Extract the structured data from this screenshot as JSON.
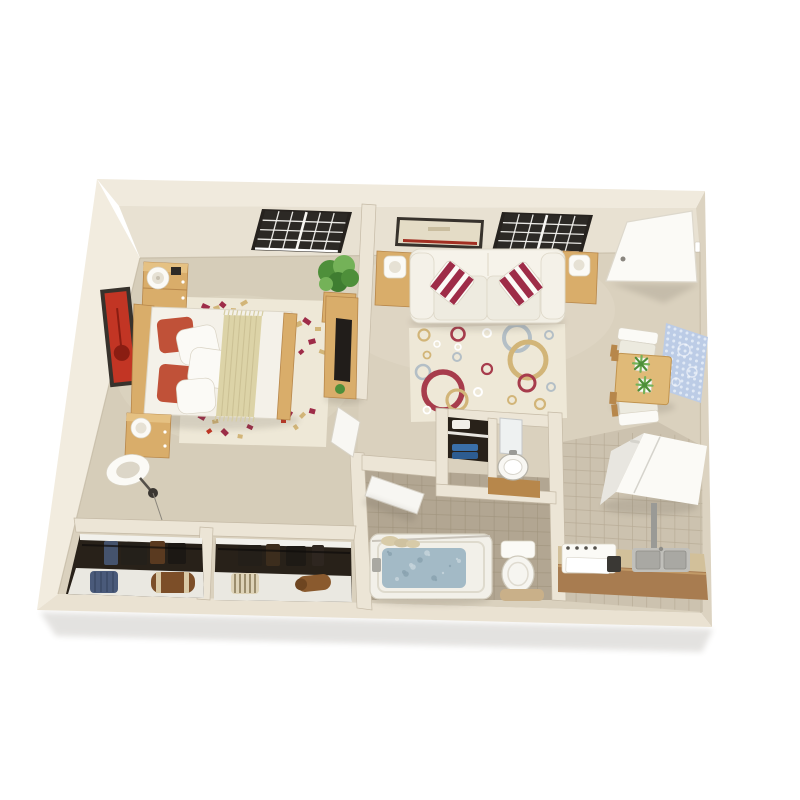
{
  "scene": {
    "type": "3d-floorplan-render",
    "description": "Isometric 3D top-down render of a one-bedroom apartment floor plan on a white background",
    "background": "#ffffff"
  },
  "palette": {
    "bg": "#ffffff",
    "wallTopFace": "#f0eadd",
    "wallInnerFace": "#e8e1d2",
    "wallFaceLeft": "#f2ecdf",
    "wallFaceRight": "#dcd3c1",
    "wallFaceBottom": "#eae2d2",
    "wallInner": "#ece5d6",
    "wallEdge": "#c5baa6",
    "floor": "#dad1be",
    "floorBedroom": "#d6cdb9",
    "floorHighlight": "#e4dcca",
    "tileKitchen": "#ccc2af",
    "tileKitchenLine": "#b7ab95",
    "tileBath": "#b2a692",
    "tileBathLine": "#a0947e",
    "closetDark": "#282119",
    "shelfWhite": "#eae8e1",
    "wood": "#d9ad6a",
    "woodDark": "#b7874b",
    "whiteFurniture": "#f3f0e7",
    "whiteBright": "#fbfaf6",
    "softShadow": "#d9d3c4",
    "accentRed": "#c05138",
    "crimson": "#9e2c48",
    "artRed": "#c23524",
    "rugCream": "#eee8d7",
    "rugGold": "#d2b578",
    "rugRed": "#a73c4c",
    "rugBlue": "#b4bfc6",
    "runnerTan": "#dcd3a7",
    "water": "#a3bac6",
    "blueRug": "#bccce6",
    "blueRugPattern": "#e6edf7",
    "plantGreen": "#4e8f3a",
    "plantGreenLight": "#74b258",
    "tvBlack": "#211d1a",
    "frameDark": "#37322c",
    "steel": "#c0bfba",
    "steelDark": "#8e8d88",
    "counterBrown": "#a87c50",
    "counterTop": "#d2c09a",
    "towelBlue": "#3a6fa8",
    "towelBlueDark": "#2d5c90",
    "matTan": "#c9b089",
    "bagBlue": "#4a5a7a",
    "bagBrown": "#7c4e28"
  },
  "rooms": [
    {
      "name": "bedroom",
      "position": "left"
    },
    {
      "name": "living-room",
      "position": "center"
    },
    {
      "name": "bathroom",
      "position": "bottom-center"
    },
    {
      "name": "kitchen",
      "position": "right"
    },
    {
      "name": "dining-nook",
      "position": "center-right"
    },
    {
      "name": "entry",
      "position": "top-right"
    },
    {
      "name": "closets",
      "position": "bottom-left",
      "count": 2
    }
  ],
  "furniture": {
    "bedroom": [
      "window",
      "red-wall-art",
      "bed-with-red-pillows",
      "tan-bed-runner",
      "confetti-area-rug",
      "nightstand-top",
      "nightstand-bottom",
      "table-lamps",
      "floor-lamp",
      "potted-plant",
      "tv-console-with-tv",
      "bedroom-door"
    ],
    "living_room": [
      "window",
      "wall-art-red-stripe",
      "white-sofa",
      "red-striped-throw-pillows",
      "end-table-left",
      "end-table-right",
      "table-lamps",
      "circles-area-rug"
    ],
    "bathroom": [
      "linen-closet-with-blue-towels",
      "vanity-mirror",
      "vanity-sink",
      "bathtub-with-water",
      "shower-curtain",
      "toilet",
      "bath-mat",
      "bathroom-door"
    ],
    "kitchen": [
      "refrigerator",
      "range",
      "stainless-double-sink",
      "brown-counter"
    ],
    "dining_nook": [
      "dining-table",
      "white-chairs",
      "potted-plants",
      "blue-pattern-rug"
    ],
    "entry": [
      "entry-door"
    ],
    "closets": [
      "hanging-clothes",
      "closet-shelves",
      "blue-bag",
      "brown-duffel",
      "striped-bag",
      "brown-roll"
    ]
  }
}
